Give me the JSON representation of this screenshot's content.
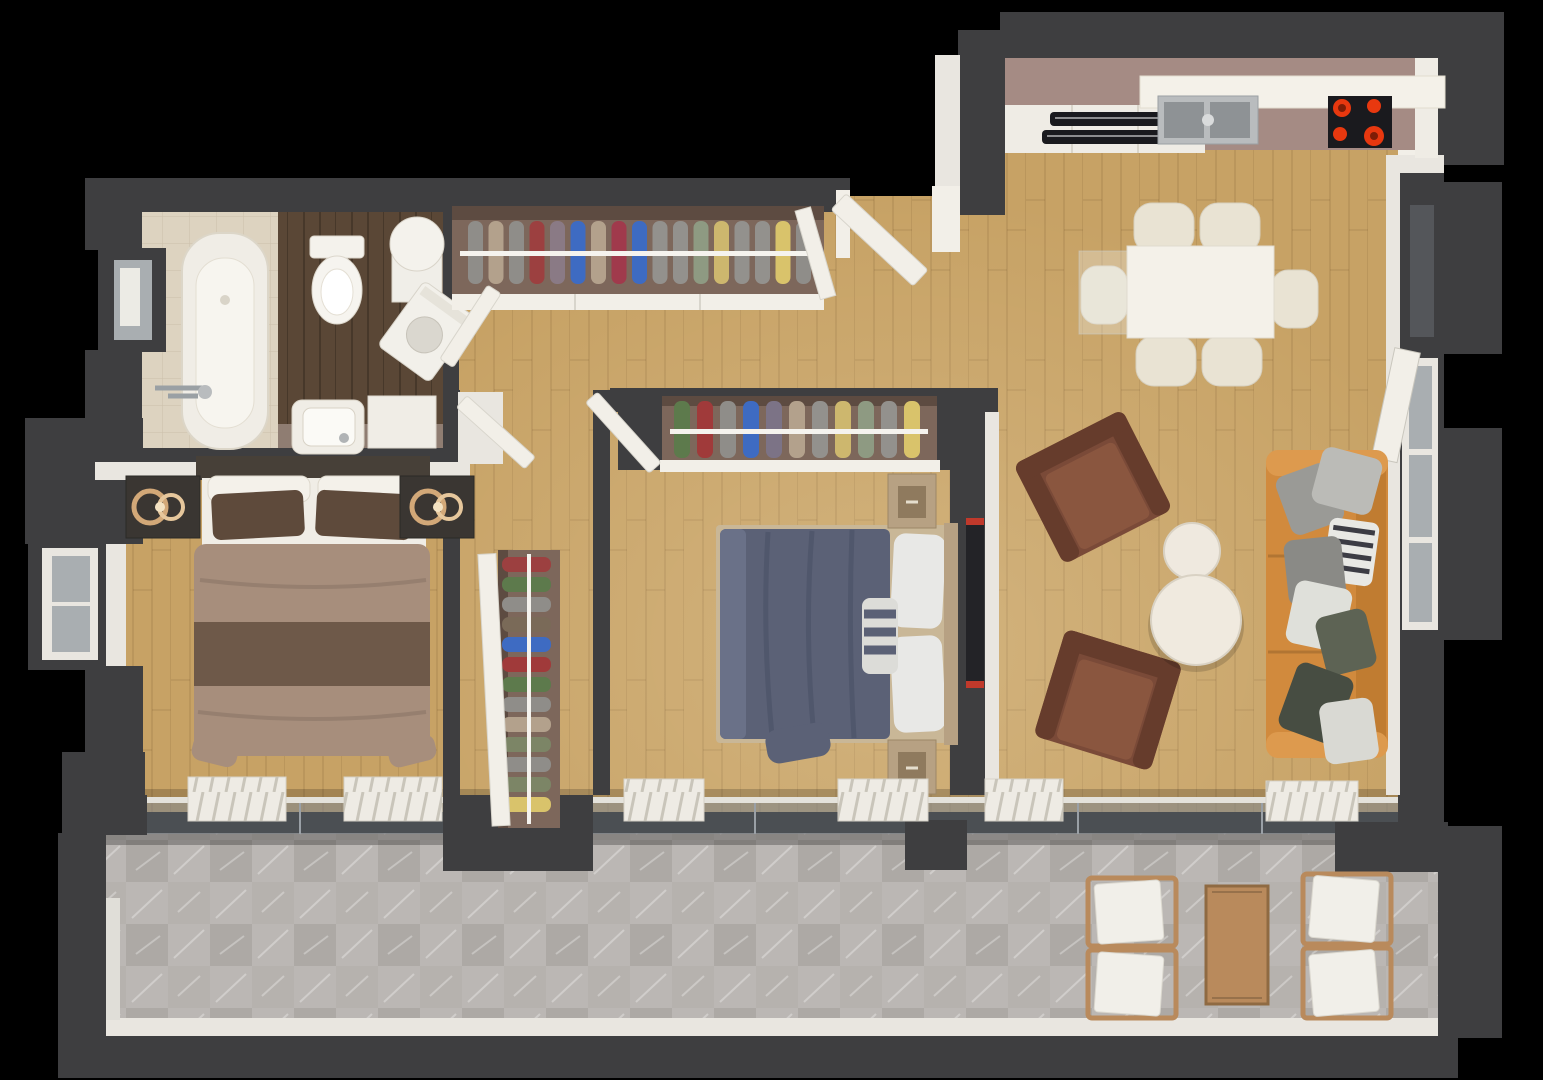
{
  "meta": {
    "content_type": "3d-floor-plan-render",
    "view": "top-down isometric",
    "background": "#000000"
  },
  "palette": {
    "wall": "#3e3e40",
    "wallShadow": "#2c2c2e",
    "trim": "#e9e6e0",
    "white": "#f2efe8",
    "floorWood": "#c7a265",
    "floorWoodDark": "#5a4736",
    "bathTile": "#ddd3c0",
    "bathShelf": "#8f7d72",
    "balconyTile": "#b6b2ae",
    "counter": "#a58b84",
    "cabinetWhite": "#efece5",
    "applianceBlack": "#1a1a1e",
    "burner": "#e8380f",
    "steel": "#b9bcbe",
    "steelDark": "#8e9295",
    "glass": "#a9aeb1",
    "glassBand": "#7d838a",
    "wardrobe": "#7d675b",
    "wardrobeDark": "#5d4b41",
    "rail": "#f5f3ee",
    "sofa": "#d18a3d",
    "sofaLight": "#dd9a4e",
    "sofaDark": "#c07c31",
    "armchair": "#7a4a38",
    "armchairDark": "#663c2c",
    "armchairSeat": "#8a563f",
    "tableCream": "#f4f1e9",
    "chairCream": "#e9e3d3",
    "bedBlue": "#5b6176",
    "bedBlueDark": "#4a5065",
    "sheetBlue": "#6a7188",
    "woodLight": "#c9b797",
    "nightstandTan": "#b7a183",
    "drawerTan": "#8f7a5e",
    "bedTan": "#a78e7c",
    "bedTanStripe": "#6e5949",
    "pillowBrown": "#5e4a3b",
    "mattress": "#f0ede6",
    "nightstandDark": "#3a3632",
    "headboardDark": "#474038",
    "lampGold": "#d2a878",
    "lampGoldLight": "#e6c79c",
    "pillowGray": "#9a9a96",
    "pillowGrayLight": "#bbbbb7",
    "pillowOlive": "#5d6354",
    "pillowOliveDark": "#474d42",
    "throw": "#dfe0da",
    "zigzagDark": "#3c3c44",
    "tvBlack": "#232327",
    "tvRed": "#c0392b",
    "radiator": "#eeebe4",
    "outdoorWood": "#b98a5c",
    "hallClothes": [
      "#8f8d89",
      "#b3a18c",
      "#8f8d89",
      "#9c4040",
      "#8a7a85",
      "#3e6bc2",
      "#b3a18c",
      "#a03a4c",
      "#3e6bc2",
      "#93918d",
      "#93918d",
      "#8e9a82",
      "#cdb76e",
      "#93918d",
      "#93918d",
      "#d9c36b",
      "#8f8d89"
    ],
    "midClothes": [
      "#5d7a4c",
      "#a03a3a",
      "#8f8d89",
      "#3e6bc2",
      "#7c7386",
      "#b3a18c",
      "#93918d",
      "#cdb76e",
      "#8e9a82",
      "#93918d",
      "#d9c36b"
    ],
    "corridorClothes": [
      "#9c4040",
      "#5d7a4c",
      "#8f8d89",
      "#7a6a58",
      "#3e6bc2",
      "#a03a3a",
      "#5d7a4c",
      "#8f8d89",
      "#b3a18c",
      "#7c8566",
      "#8f8d89",
      "#7c8566",
      "#d9c36b"
    ]
  },
  "rooms": [
    {
      "name": "bathroom",
      "furniture": [
        "bathtub",
        "toilet",
        "washing-machine",
        "water-heater",
        "sink",
        "vanity-cabinet",
        "window"
      ]
    },
    {
      "name": "hallway",
      "furniture": [
        "open-wardrobe-with-clothes",
        "entry-door"
      ]
    },
    {
      "name": "kitchen",
      "furniture": [
        "counter",
        "upper-counter",
        "sink",
        "cooktop-4-burners",
        "oven-vents"
      ]
    },
    {
      "name": "living-dining-room",
      "furniture": [
        "dining-table",
        "6-chairs",
        "2-armchairs",
        "2-round-coffee-tables",
        "3-seat-sofa-with-pillows",
        "windows"
      ]
    },
    {
      "name": "bedroom-1",
      "furniture": [
        "double-bed-brown",
        "2-dark-nightstands",
        "2-ring-lamps",
        "window-bay",
        "radiators"
      ]
    },
    {
      "name": "bedroom-2",
      "furniture": [
        "double-bed-blue",
        "wardrobe-with-clothes",
        "2-nightstands",
        "wall-tv",
        "radiators"
      ]
    },
    {
      "name": "corridor",
      "furniture": [
        "tall-wardrobe-with-clothes",
        "doors"
      ]
    },
    {
      "name": "balcony",
      "furniture": [
        "wooden-table",
        "4-cushioned-chairs",
        "sliding-glass-doors"
      ]
    }
  ]
}
